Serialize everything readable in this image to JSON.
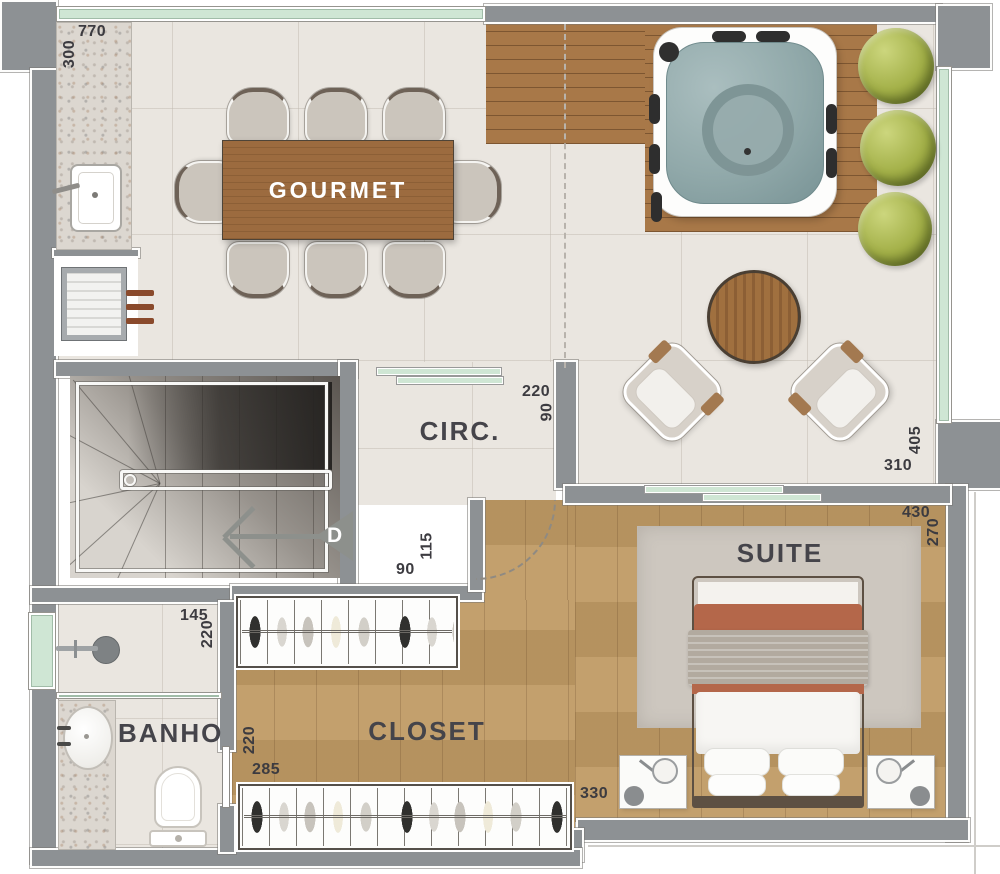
{
  "plan": {
    "labels": {
      "gourmet": "GOURMET",
      "circ": "CIRC.",
      "suite": "SUITE",
      "banho": "BANHO",
      "closet": "CLOSET",
      "stairs_direction": "D"
    },
    "dimensions": {
      "gourmet_width": "770",
      "gourmet_depth": "300",
      "circ_width": "220",
      "circ_depth": "90",
      "stairs_passage_width": "90",
      "stairs_passage_depth": "115",
      "living_width": "310",
      "living_depth": "405",
      "suite_width": "430",
      "suite_depth": "270",
      "suite_bed_wall": "330",
      "banho_width": "145",
      "banho_depth": "220",
      "closet_depth": "220",
      "closet_width": "285"
    },
    "colors": {
      "wall": "#8d9194",
      "tile_floor": "#eae6e0",
      "wood_floor": "#bf9a64",
      "deck_wood": "#a87848",
      "table_wood": "#9c6b3f",
      "granite": "#dcd7d0",
      "glass": "#cfe6d4",
      "water": "#91a9aa",
      "plant": "#a3b048",
      "rug": "#cdc7bf",
      "bed_accent": "#b4674a",
      "label_text": "#45444a"
    }
  }
}
